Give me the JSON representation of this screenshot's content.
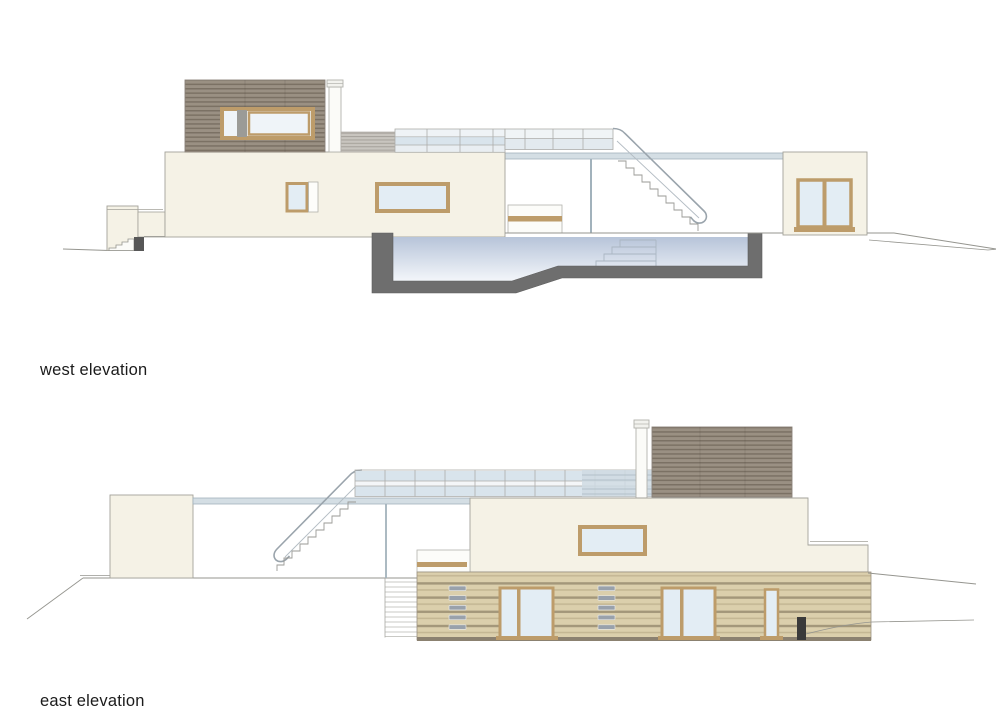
{
  "document": {
    "type": "architectural elevation drawings",
    "background": "#ffffff"
  },
  "figures": [
    {
      "id": "west-elevation",
      "label": "west elevation"
    },
    {
      "id": "east-elevation",
      "label": "east elevation"
    }
  ],
  "palette": {
    "wall_cream": "#f5f2e6",
    "wall_outline": "#a3a29a",
    "wood_dark_base": "#9a9083",
    "wood_dark_stripe": "#7b7164",
    "wood_light_base": "#dbcfac",
    "wood_light_stripe": "#a3977a",
    "wood_light_mid": "#c3b693",
    "frame_tan": "#bd9c6a",
    "glass_blue": "#e3edf4",
    "glass_pale": "#eff4f8",
    "slab_fill": "#d4dee4",
    "slab_edge": "#a2b2bc",
    "railing_blue": "#d9e4ec",
    "railing_pale": "#eff3f6",
    "louver_base": "#c8c5bf",
    "louver_stripe": "#a8a49d",
    "mullion_grey": "#9b9b97",
    "pool_wall": "#6e6e6e",
    "block_grey": "#575757",
    "water_top": "#b7c4d9",
    "water_bottom": "#f3f6fa",
    "line_grey": "#95958f",
    "outline_soft": "#b2b2ac",
    "step_line": "#aab6c2",
    "vent_grey": "#99a1ab",
    "dark_element": "#3a3a3a",
    "chimney_fill": "#fbfbf8",
    "label_text": "#1b1b1b"
  }
}
